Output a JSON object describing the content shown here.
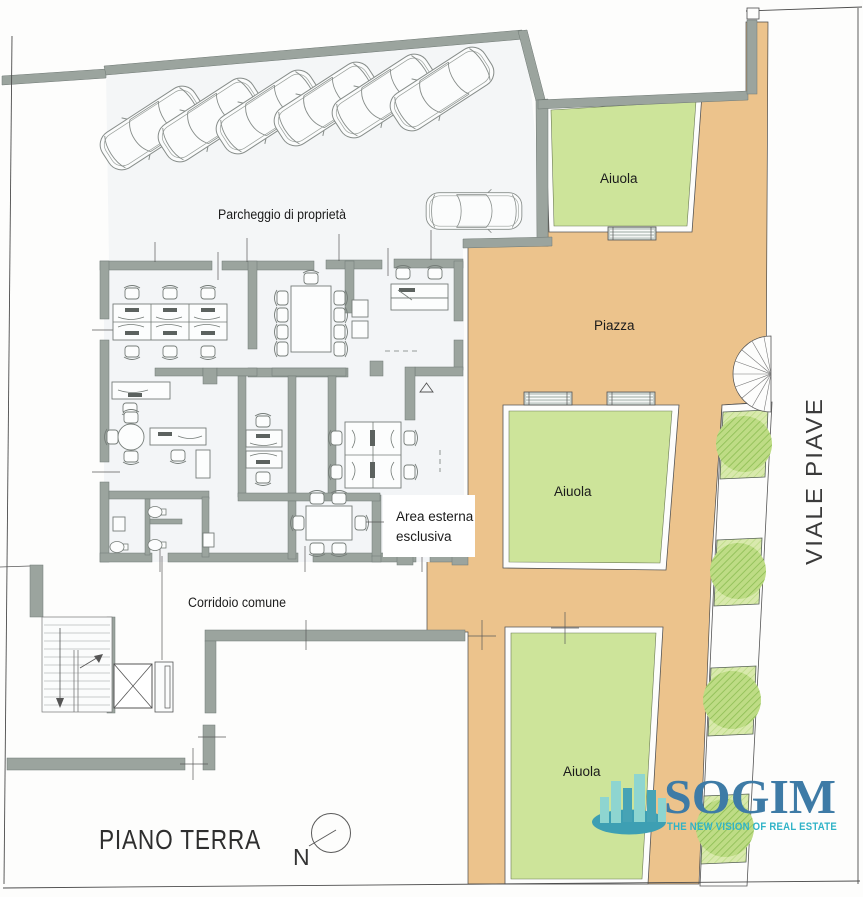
{
  "plan": {
    "floor_title": "PIANO TERRA",
    "north_label": "N",
    "street_name": "VIALE PIAVE",
    "labels": {
      "parking": "Parcheggio di proprietà",
      "piazza": "Piazza",
      "aiuola_top": "Aiuola",
      "aiuola_middle": "Aiuola",
      "aiuola_bottom": "Aiuola",
      "corridor": "Corridoio comune",
      "external_area_line1": "Area esterna",
      "external_area_line2": "esclusiva"
    },
    "colors": {
      "wall": "#9ba49e",
      "paving": "#ecc38c",
      "lawn": "#cde49a",
      "lawn_hatch": "#d9e9ad",
      "floor": "#f4f6f7",
      "line": "#4c4c4c"
    }
  },
  "logo": {
    "brand": "SOGIM",
    "tagline": "THE NEW VISION OF REAL ESTATE",
    "brand_color": "#3e7ba6",
    "tagline_color": "#2fb3c7",
    "icon_light": "#8ed5d0",
    "icon_dark": "#47a3b5",
    "icon_base": "#3d9fb3"
  }
}
